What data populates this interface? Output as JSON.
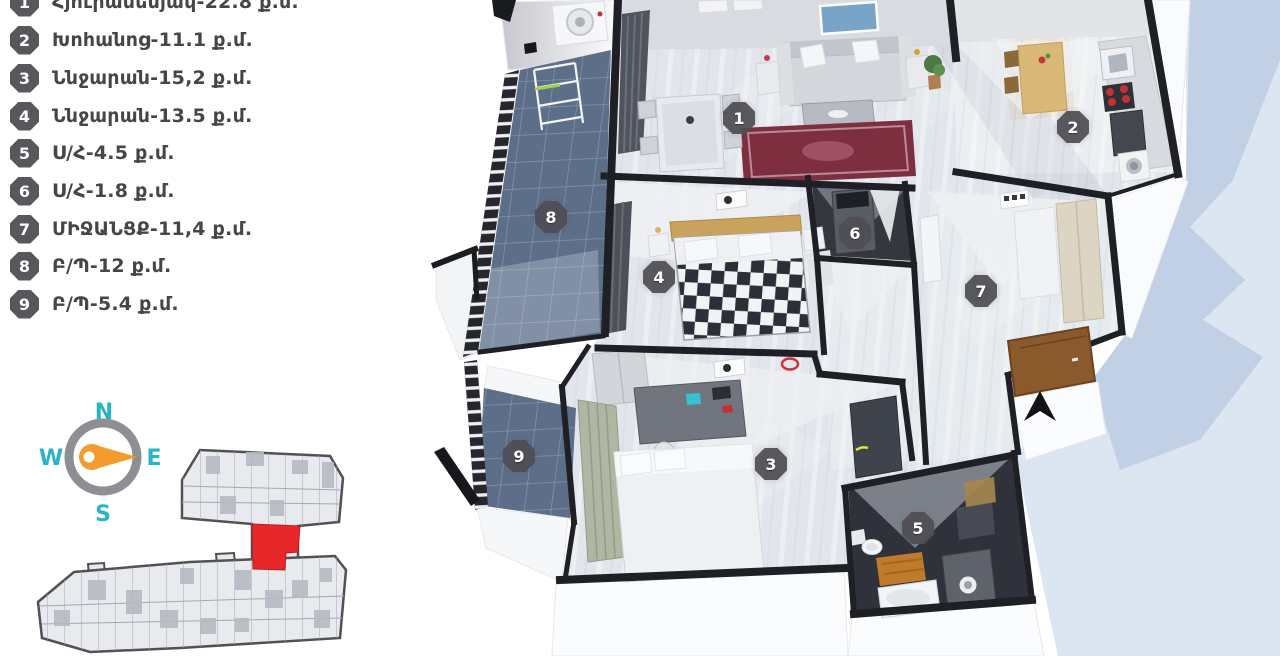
{
  "colors": {
    "accent_teal": "#2ab3c6",
    "needle_orange": "#f49b2d",
    "unit_red": "#e8272b",
    "marker_bg": "#4f4f54",
    "legend_text": "#46464a",
    "shadow_light": "#dce5f2",
    "shadow_dark": "#c2d0e6",
    "balcony_tile": "#5d6e89"
  },
  "legend": {
    "items": [
      {
        "num": "1",
        "label": "Հյուրասենյակ-22.8 ք.մ."
      },
      {
        "num": "2",
        "label": "Խոհանոց-11.1 ք.մ."
      },
      {
        "num": "3",
        "label": "Ննջարան-15,2 ք.մ."
      },
      {
        "num": "4",
        "label": "Ննջարան-13.5 ք.մ."
      },
      {
        "num": "5",
        "label": "Ս/Հ-4.5 ք.մ."
      },
      {
        "num": "6",
        "label": "Ս/Հ-1.8 ք.մ."
      },
      {
        "num": "7",
        "label": "ՄԻՋԱՆՑՔ-11,4 ք.մ."
      },
      {
        "num": "8",
        "label": "Բ/Պ-12 ք.մ."
      },
      {
        "num": "9",
        "label": "Բ/Պ-5.4 ք.մ."
      }
    ]
  },
  "compass": {
    "north": "N",
    "south": "S",
    "west": "W",
    "east": "E"
  },
  "plan": {
    "markers": [
      {
        "label": "1"
      },
      {
        "label": "2"
      },
      {
        "label": "3"
      },
      {
        "label": "4"
      },
      {
        "label": "5"
      },
      {
        "label": "6"
      },
      {
        "label": "7"
      },
      {
        "label": "8"
      },
      {
        "label": "9"
      }
    ]
  }
}
